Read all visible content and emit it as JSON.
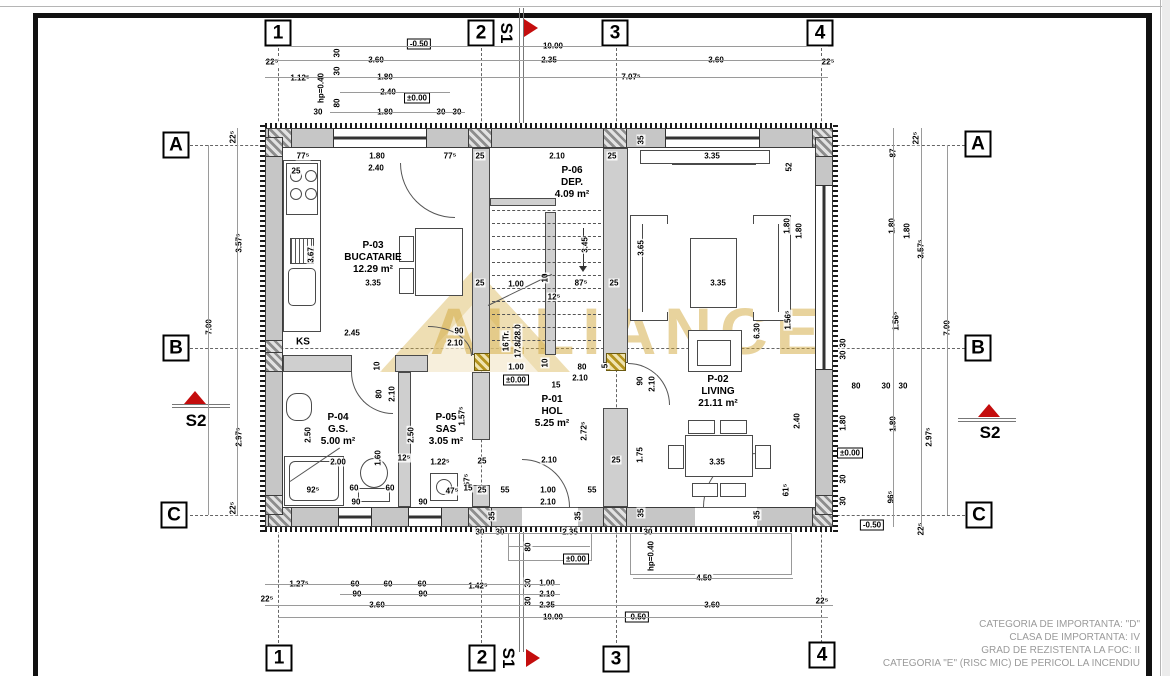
{
  "watermark": "ALLIANCE",
  "sections": {
    "s1": "S1",
    "s2": "S2"
  },
  "labels": {
    "ks": "KS"
  },
  "grid": {
    "markers": [
      {
        "label": "1",
        "x": 278,
        "y": 33
      },
      {
        "label": "2",
        "x": 481,
        "y": 33
      },
      {
        "label": "3",
        "x": 615,
        "y": 33
      },
      {
        "label": "4",
        "x": 820,
        "y": 33
      },
      {
        "label": "1",
        "x": 279,
        "y": 658
      },
      {
        "label": "2",
        "x": 482,
        "y": 658
      },
      {
        "label": "3",
        "x": 616,
        "y": 659
      },
      {
        "label": "4",
        "x": 822,
        "y": 655
      },
      {
        "label": "A",
        "x": 176,
        "y": 145
      },
      {
        "label": "B",
        "x": 176,
        "y": 348
      },
      {
        "label": "C",
        "x": 174,
        "y": 515
      },
      {
        "label": "A",
        "x": 978,
        "y": 144
      },
      {
        "label": "B",
        "x": 978,
        "y": 348
      },
      {
        "label": "C",
        "x": 979,
        "y": 515
      }
    ]
  },
  "rooms": [
    {
      "id": "P-03",
      "name": "BUCATARIE",
      "area": "12.29 m²",
      "x": 373,
      "y": 258
    },
    {
      "id": "P-06",
      "name": "DEP.",
      "area": "4.09 m²",
      "x": 572,
      "y": 183
    },
    {
      "id": "P-02",
      "name": "LIVING",
      "area": "21.11 m²",
      "x": 718,
      "y": 392
    },
    {
      "id": "P-04",
      "name": "G.S.",
      "area": "5.00 m²",
      "x": 338,
      "y": 430
    },
    {
      "id": "P-05",
      "name": "SAS",
      "area": "3.05 m²",
      "x": 446,
      "y": 430
    },
    {
      "id": "P-01",
      "name": "HOL",
      "area": "5.25 m²",
      "x": 552,
      "y": 412
    }
  ],
  "notes": [
    "CATEGORIA DE IMPORTANTA: \"D\"",
    "CLASA DE IMPORTANTA: IV",
    "GRAD DE REZISTENTA LA FOC: II",
    "CATEGORIA \"E\" (RISC MIC) DE PERICOL LA INCENDIU"
  ],
  "dimensions": [
    [
      "-0.50",
      419,
      44,
      0,
      1
    ],
    [
      "10.00",
      553,
      46
    ],
    [
      "22⁵",
      272,
      62
    ],
    [
      "3.60",
      376,
      60
    ],
    [
      "2.35",
      549,
      60
    ],
    [
      "3.60",
      716,
      60
    ],
    [
      "22⁵",
      828,
      62
    ],
    [
      "1.12⁵",
      300,
      78
    ],
    [
      "1.80",
      385,
      77
    ],
    [
      "7.07⁵",
      631,
      77
    ],
    [
      "2.40",
      388,
      92
    ],
    [
      "±0.00",
      417,
      98,
      0,
      1
    ],
    [
      "hp=0.40",
      321,
      88,
      -90
    ],
    [
      "30",
      337,
      53,
      -90
    ],
    [
      "30",
      337,
      71,
      -90
    ],
    [
      "80",
      337,
      103,
      -90
    ],
    [
      "30",
      318,
      112
    ],
    [
      "1.80",
      385,
      112
    ],
    [
      "30",
      441,
      112
    ],
    [
      "30",
      457,
      112
    ],
    [
      "77⁵",
      303,
      156
    ],
    [
      "1.80",
      377,
      156
    ],
    [
      "77⁵",
      450,
      156
    ],
    [
      "25",
      480,
      156
    ],
    [
      "2.10",
      557,
      156
    ],
    [
      "25",
      612,
      156
    ],
    [
      "3.35",
      712,
      156
    ],
    [
      "2.40",
      376,
      168
    ],
    [
      "25",
      296,
      171
    ],
    [
      "52",
      789,
      167,
      -90
    ],
    [
      "35",
      641,
      140,
      -90
    ],
    [
      "22⁵",
      233,
      137,
      -90
    ],
    [
      "3.57⁵",
      239,
      243,
      -90
    ],
    [
      "7.00",
      209,
      327,
      -90
    ],
    [
      "2.97⁵",
      239,
      437,
      -90
    ],
    [
      "22⁵",
      233,
      508,
      -90
    ],
    [
      "22⁵",
      916,
      138,
      -90
    ],
    [
      "87",
      893,
      153,
      -90
    ],
    [
      "1.80",
      892,
      226,
      -90
    ],
    [
      "1.80",
      907,
      231,
      -90
    ],
    [
      "3.57⁵",
      921,
      249,
      -90
    ],
    [
      "1.56⁵",
      896,
      321,
      -90
    ],
    [
      "7.00",
      947,
      328,
      -90
    ],
    [
      "2.97⁵",
      929,
      437,
      -90
    ],
    [
      "30",
      843,
      343,
      -90
    ],
    [
      "30",
      843,
      355,
      -90
    ],
    [
      "80",
      856,
      386
    ],
    [
      "30",
      886,
      386
    ],
    [
      "30",
      903,
      386
    ],
    [
      "1.80",
      843,
      423,
      -90
    ],
    [
      "2.40",
      797,
      421,
      -90
    ],
    [
      "1.80",
      893,
      424,
      -90
    ],
    [
      "±0.00",
      850,
      453,
      0,
      1
    ],
    [
      "30",
      843,
      479,
      -90
    ],
    [
      "30",
      843,
      501,
      -90
    ],
    [
      "96⁵",
      891,
      497,
      -90
    ],
    [
      "-0.50",
      872,
      525,
      0,
      1
    ],
    [
      "22⁵",
      921,
      529,
      -90
    ],
    [
      "3.35",
      373,
      283
    ],
    [
      "2.45",
      352,
      333
    ],
    [
      "3.67",
      311,
      255,
      -90
    ],
    [
      "90",
      459,
      331
    ],
    [
      "2.10",
      455,
      343
    ],
    [
      "25",
      480,
      283
    ],
    [
      "1.00",
      516,
      284
    ],
    [
      "10",
      545,
      278,
      -90
    ],
    [
      "87⁵",
      581,
      283
    ],
    [
      "25",
      614,
      283
    ],
    [
      "12⁵",
      554,
      297
    ],
    [
      "3.45",
      585,
      245,
      -90
    ],
    [
      "3.65",
      641,
      248,
      -90
    ],
    [
      "16 Tr.",
      506,
      341,
      -90
    ],
    [
      "17.8/28.0",
      518,
      341,
      -90
    ],
    [
      "1.00",
      516,
      367
    ],
    [
      "10",
      545,
      363,
      -90
    ],
    [
      "80",
      582,
      367
    ],
    [
      "5",
      605,
      366,
      -90
    ],
    [
      "±0.00",
      516,
      380,
      0,
      1
    ],
    [
      "15",
      556,
      385
    ],
    [
      "2.10",
      580,
      378
    ],
    [
      "2.72⁵",
      584,
      431,
      -90
    ],
    [
      "90",
      640,
      381,
      -90
    ],
    [
      "2.10",
      652,
      384,
      -90
    ],
    [
      "1.75",
      640,
      455,
      -90
    ],
    [
      "25",
      616,
      460
    ],
    [
      "2.10",
      549,
      460
    ],
    [
      "3.35",
      718,
      283
    ],
    [
      "1.56⁵",
      788,
      320,
      -90
    ],
    [
      "6.30",
      757,
      331,
      -90
    ],
    [
      "1.80",
      787,
      226,
      -90
    ],
    [
      "1.80",
      799,
      231,
      -90
    ],
    [
      "3.35",
      717,
      462
    ],
    [
      "61⁵",
      786,
      490,
      -90
    ],
    [
      "10",
      377,
      366,
      -90
    ],
    [
      "80",
      379,
      394,
      -90
    ],
    [
      "2.10",
      392,
      394,
      -90
    ],
    [
      "2.50",
      308,
      435,
      -90
    ],
    [
      "2.50",
      411,
      435,
      -90
    ],
    [
      "1.60",
      378,
      458,
      -90
    ],
    [
      "12⁵",
      404,
      458
    ],
    [
      "2.00",
      338,
      462
    ],
    [
      "92⁵",
      313,
      490
    ],
    [
      "60",
      354,
      488
    ],
    [
      "60",
      390,
      488
    ],
    [
      "90",
      356,
      502
    ],
    [
      "90",
      423,
      502
    ],
    [
      "1.22⁵",
      440,
      462
    ],
    [
      "1.57⁵",
      462,
      416,
      -90
    ],
    [
      "67⁵",
      467,
      480,
      -90
    ],
    [
      "47⁵",
      452,
      491
    ],
    [
      "15",
      468,
      488
    ],
    [
      "25",
      482,
      461
    ],
    [
      "25",
      482,
      490
    ],
    [
      "55",
      505,
      490
    ],
    [
      "1.00",
      548,
      490
    ],
    [
      "55",
      592,
      490
    ],
    [
      "2.10",
      548,
      502
    ],
    [
      "30",
      480,
      532
    ],
    [
      "30",
      500,
      532
    ],
    [
      "2.35",
      570,
      532
    ],
    [
      "30",
      648,
      532
    ],
    [
      "35",
      492,
      516,
      -90
    ],
    [
      "35",
      578,
      516,
      -90
    ],
    [
      "35",
      641,
      513,
      -90
    ],
    [
      "35",
      757,
      515,
      -90
    ],
    [
      "80",
      528,
      547,
      -90
    ],
    [
      "±0.00",
      576,
      559,
      0,
      1
    ],
    [
      "hp=0.40",
      651,
      556,
      -90
    ],
    [
      "1.27⁵",
      299,
      584
    ],
    [
      "60",
      355,
      584
    ],
    [
      "60",
      388,
      584
    ],
    [
      "60",
      422,
      584
    ],
    [
      "1.42⁵",
      478,
      586
    ],
    [
      "30",
      528,
      583,
      -90
    ],
    [
      "1.00",
      547,
      583
    ],
    [
      "90",
      357,
      594
    ],
    [
      "90",
      423,
      594
    ],
    [
      "2.10",
      547,
      594
    ],
    [
      "30",
      528,
      601,
      -90
    ],
    [
      "22⁵",
      267,
      599
    ],
    [
      "3.60",
      377,
      605
    ],
    [
      "2.35",
      547,
      605
    ],
    [
      "4.50",
      704,
      578
    ],
    [
      "3.60",
      712,
      605
    ],
    [
      "22⁵",
      822,
      601
    ],
    [
      "10.00",
      553,
      617
    ],
    [
      "-0.50",
      637,
      617,
      0,
      1
    ]
  ]
}
